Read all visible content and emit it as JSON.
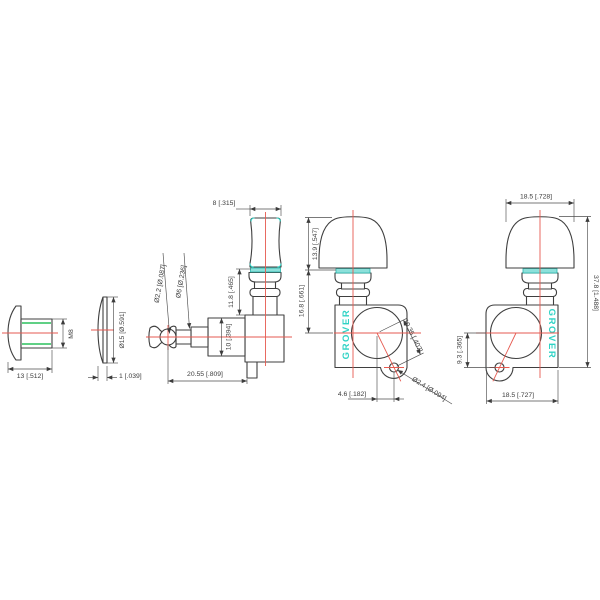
{
  "drawing": {
    "brand": "GROVER",
    "colors": {
      "outline": "#3f3f3f",
      "centerline": "#e65a50",
      "accent_cyan": "#2fd3c5",
      "thread_green": "#00b33c",
      "dimension_text": "#3c3c3c"
    },
    "views": {
      "bushing": {
        "length": "13 [.512]",
        "thread_size": "M8"
      },
      "washer": {
        "thickness": "1 [.039]",
        "diameter": "Ø15 [Ø.591]"
      },
      "tuner_side": {
        "button_thickness": "8 [.315]",
        "shaft_hole_diameter": "Ø2.2 [Ø.087]",
        "post_diameter": "Ø6 [Ø.236]",
        "washer_to_housing": "11.8 [.465]",
        "gearbox_height": "10 [.394]",
        "overall_depth": "20.55 [.809]"
      },
      "tuner_front": {
        "logo": "GROVER",
        "button_height": "13.9 [.547]",
        "washer_to_gear_center": "16.8 [.661]",
        "gear_to_screw_center": "10.35 [.407]",
        "screw_hole_diameter": "Ø2.4 [Ø.094]",
        "screw_offset_horizontal": "4.6 [.182]"
      },
      "tuner_rear": {
        "logo": "GROVER",
        "button_width": "18.5 [.728]",
        "overall_height": "37.8 [1.488]",
        "screw_offset_vertical": "9.3 [.365]",
        "housing_width": "18.5 [.727]"
      }
    }
  }
}
